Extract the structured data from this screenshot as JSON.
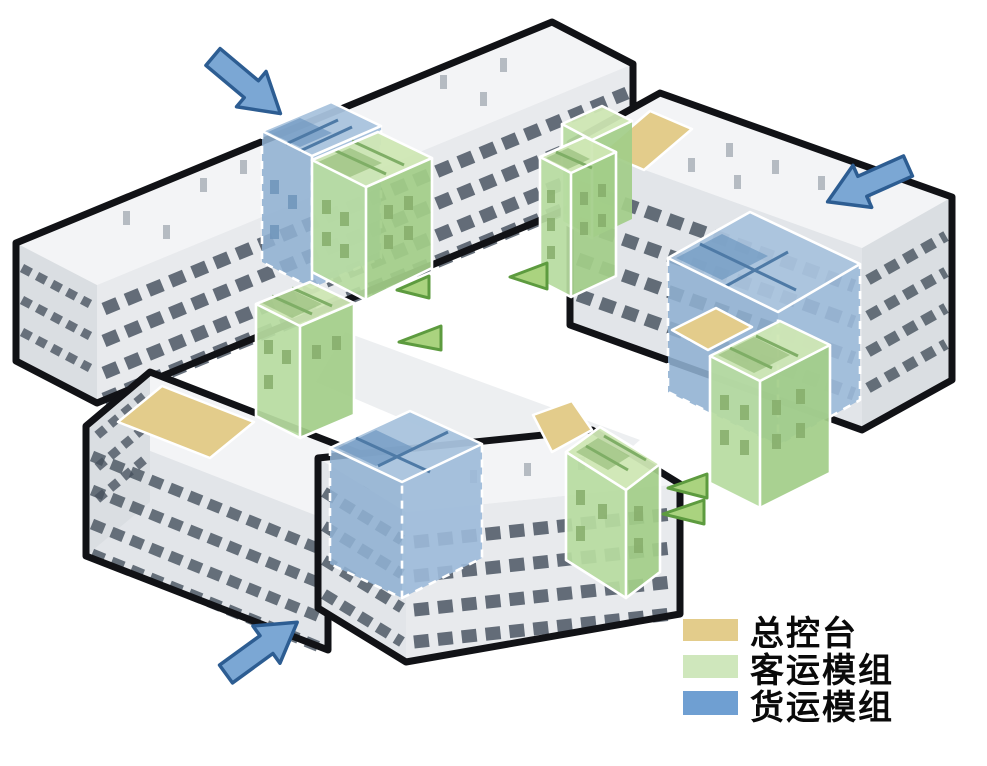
{
  "page": {
    "background": "#ffffff",
    "description": "Axonometric diagram of a four-wing building complex around a central courtyard, with colored functional modules inserted into the wings"
  },
  "legend": {
    "items": [
      {
        "id": "console",
        "label": "总控台",
        "color": "#e3cc8b"
      },
      {
        "id": "passenger",
        "label": "客运模组",
        "color": "#cfe7bc"
      },
      {
        "id": "freight",
        "label": "货运模组",
        "color": "#6f9fd2"
      }
    ]
  },
  "annotations": {
    "arrow_color": "#7ba7d4",
    "entry_arrows": [
      {
        "position": "top-left",
        "direction": "down-right"
      },
      {
        "position": "right",
        "direction": "down-left"
      },
      {
        "position": "bottom-left",
        "direction": "up-right"
      }
    ],
    "courtyard_markers": {
      "count": 5,
      "shape": "triangle-flag",
      "color": "#aad37f"
    }
  },
  "scene": {
    "buildings": [
      "northwest-wing",
      "east-wing",
      "southwest-wing",
      "south-wing"
    ],
    "modules": [
      {
        "building": "northwest-wing",
        "type": "货运模组"
      },
      {
        "building": "northwest-wing",
        "type": "客运模组"
      },
      {
        "building": "east-wing",
        "type": "总控台"
      },
      {
        "building": "east-wing",
        "type": "客运模组"
      },
      {
        "building": "east-wing",
        "type": "货运模组"
      },
      {
        "building": "east-wing",
        "type": "总控台"
      },
      {
        "building": "east-wing",
        "type": "客运模组"
      },
      {
        "building": "southwest-wing",
        "type": "总控台"
      },
      {
        "building": "southwest-wing",
        "type": "客运模组"
      },
      {
        "building": "south-wing",
        "type": "货运模组"
      },
      {
        "building": "south-wing",
        "type": "总控台"
      },
      {
        "building": "south-wing",
        "type": "客运模组"
      }
    ]
  }
}
